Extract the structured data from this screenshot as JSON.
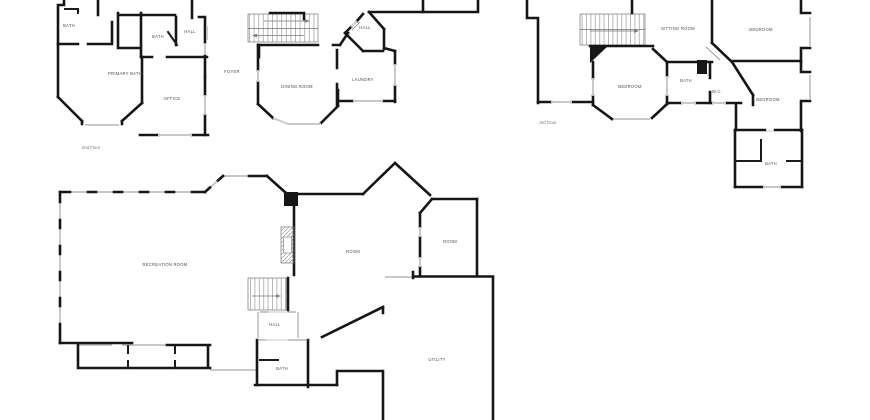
{
  "document": {
    "type": "floor-plan-sheet",
    "background_color": "#ffffff",
    "wall_color": "#161616",
    "window_color": "#c8c8c8",
    "label_color": "#4d4d4d"
  },
  "floorplans": [
    {
      "id": "second-floor",
      "floor_label": "2nd Floor",
      "rooms": [
        {
          "label": "BATH"
        },
        {
          "label": "BATH"
        },
        {
          "label": "HALL"
        },
        {
          "label": "PRIMARY BATH"
        },
        {
          "label": "OFFICE"
        },
        {
          "label": "FOYER"
        },
        {
          "label": "DINING ROOM"
        },
        {
          "label": "LAUNDRY"
        },
        {
          "label": "HALL"
        }
      ]
    },
    {
      "id": "third-floor",
      "floor_label": "3rd Floor",
      "rooms": [
        {
          "label": "SITTING ROOM"
        },
        {
          "label": "BEDROOM"
        },
        {
          "label": "BEDROOM"
        },
        {
          "label": "BATH"
        },
        {
          "label": "W.C."
        },
        {
          "label": "BEDROOM"
        },
        {
          "label": "BATH"
        }
      ]
    },
    {
      "id": "lower-floor",
      "floor_label": "",
      "rooms": [
        {
          "label": "RECREATION ROOM"
        },
        {
          "label": "ROOM"
        },
        {
          "label": "ROOM"
        },
        {
          "label": "HALL"
        },
        {
          "label": "BATH"
        },
        {
          "label": "UTILITY"
        }
      ]
    }
  ]
}
